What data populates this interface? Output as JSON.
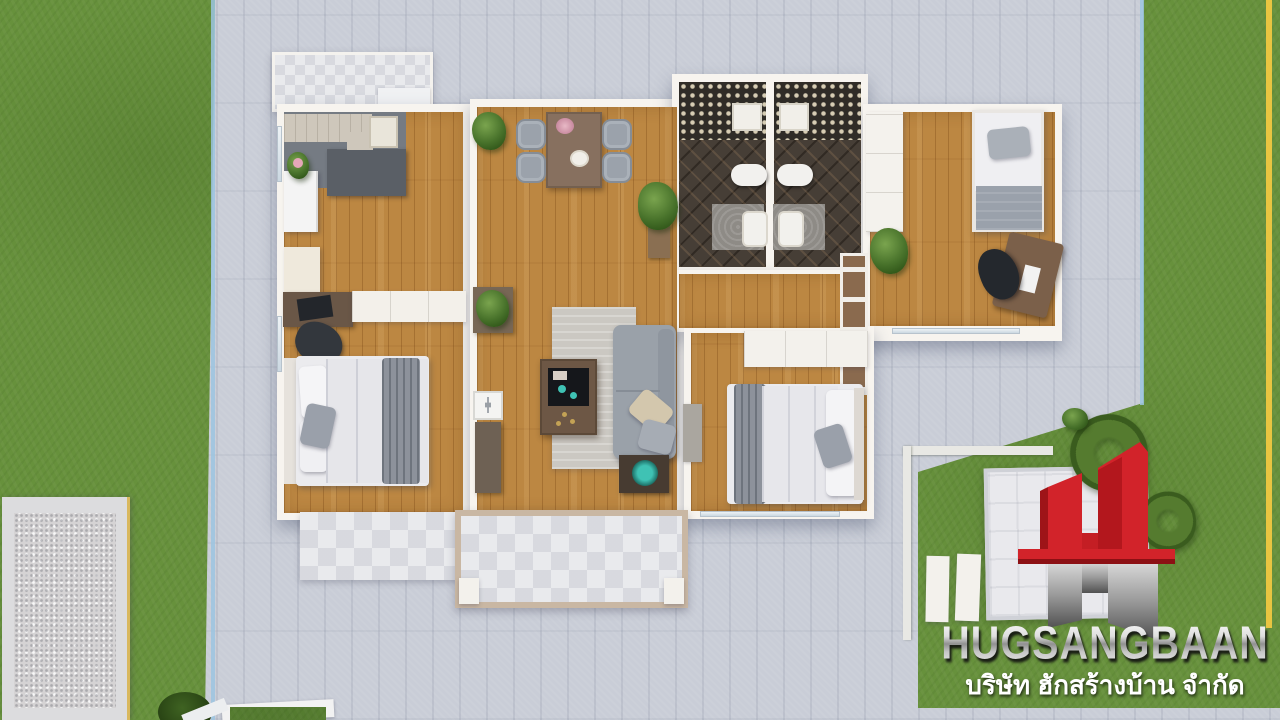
{
  "branding": {
    "company_name": "HUGSANGBAAN",
    "company_name_thai": "บริษัท ฮักสร้างบ้าน จำกัด",
    "logo_symbol": "red and mirrored-gray letter-H building mark"
  },
  "palette": {
    "grass_green": "#67913c",
    "concrete_gray": "#c9cdd7",
    "wood_floor": "#bc8742",
    "wall_white": "#f7f4ef",
    "logo_red": "#d2232a",
    "logo_silver": "#c9c9c9",
    "bathroom_dark_tile": "#463e36",
    "sofa_gray": "#9aa1a9",
    "accent_teal": "#35b8ab",
    "boundary_yellow": "#e9c541",
    "boundary_blue": "#9cc4e0"
  },
  "scene": {
    "type": "top-down 3D architectural render of a single-storey house",
    "rooms": [
      "kitchen",
      "dining area",
      "living room",
      "left bedroom",
      "top-right bedroom",
      "bottom-right bedroom",
      "bathroom 1",
      "bathroom 2",
      "hallway",
      "front porch",
      "rear terrace"
    ],
    "outdoor": [
      "lawn",
      "concrete pavement",
      "gravel patio",
      "logo lawn with paved square"
    ]
  }
}
